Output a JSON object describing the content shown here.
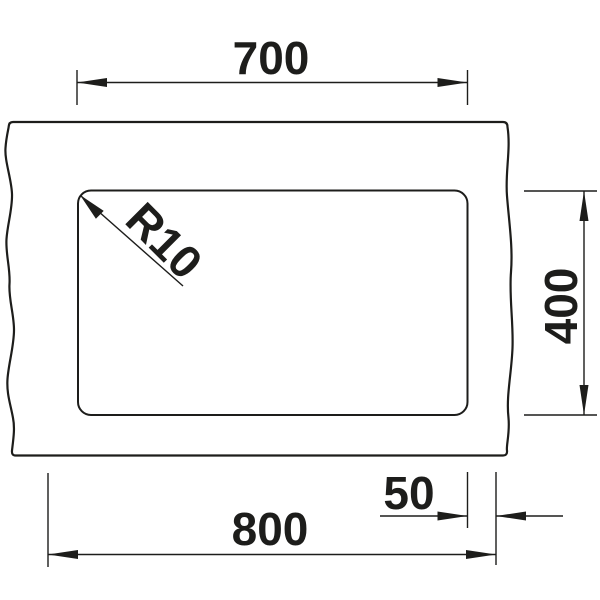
{
  "colors": {
    "line": "#1d1d1b",
    "background": "#ffffff"
  },
  "dimensions": {
    "top_width": "700",
    "right_height": "400",
    "bottom_width": "800",
    "right_offset": "50",
    "corner_radius": "R10"
  }
}
